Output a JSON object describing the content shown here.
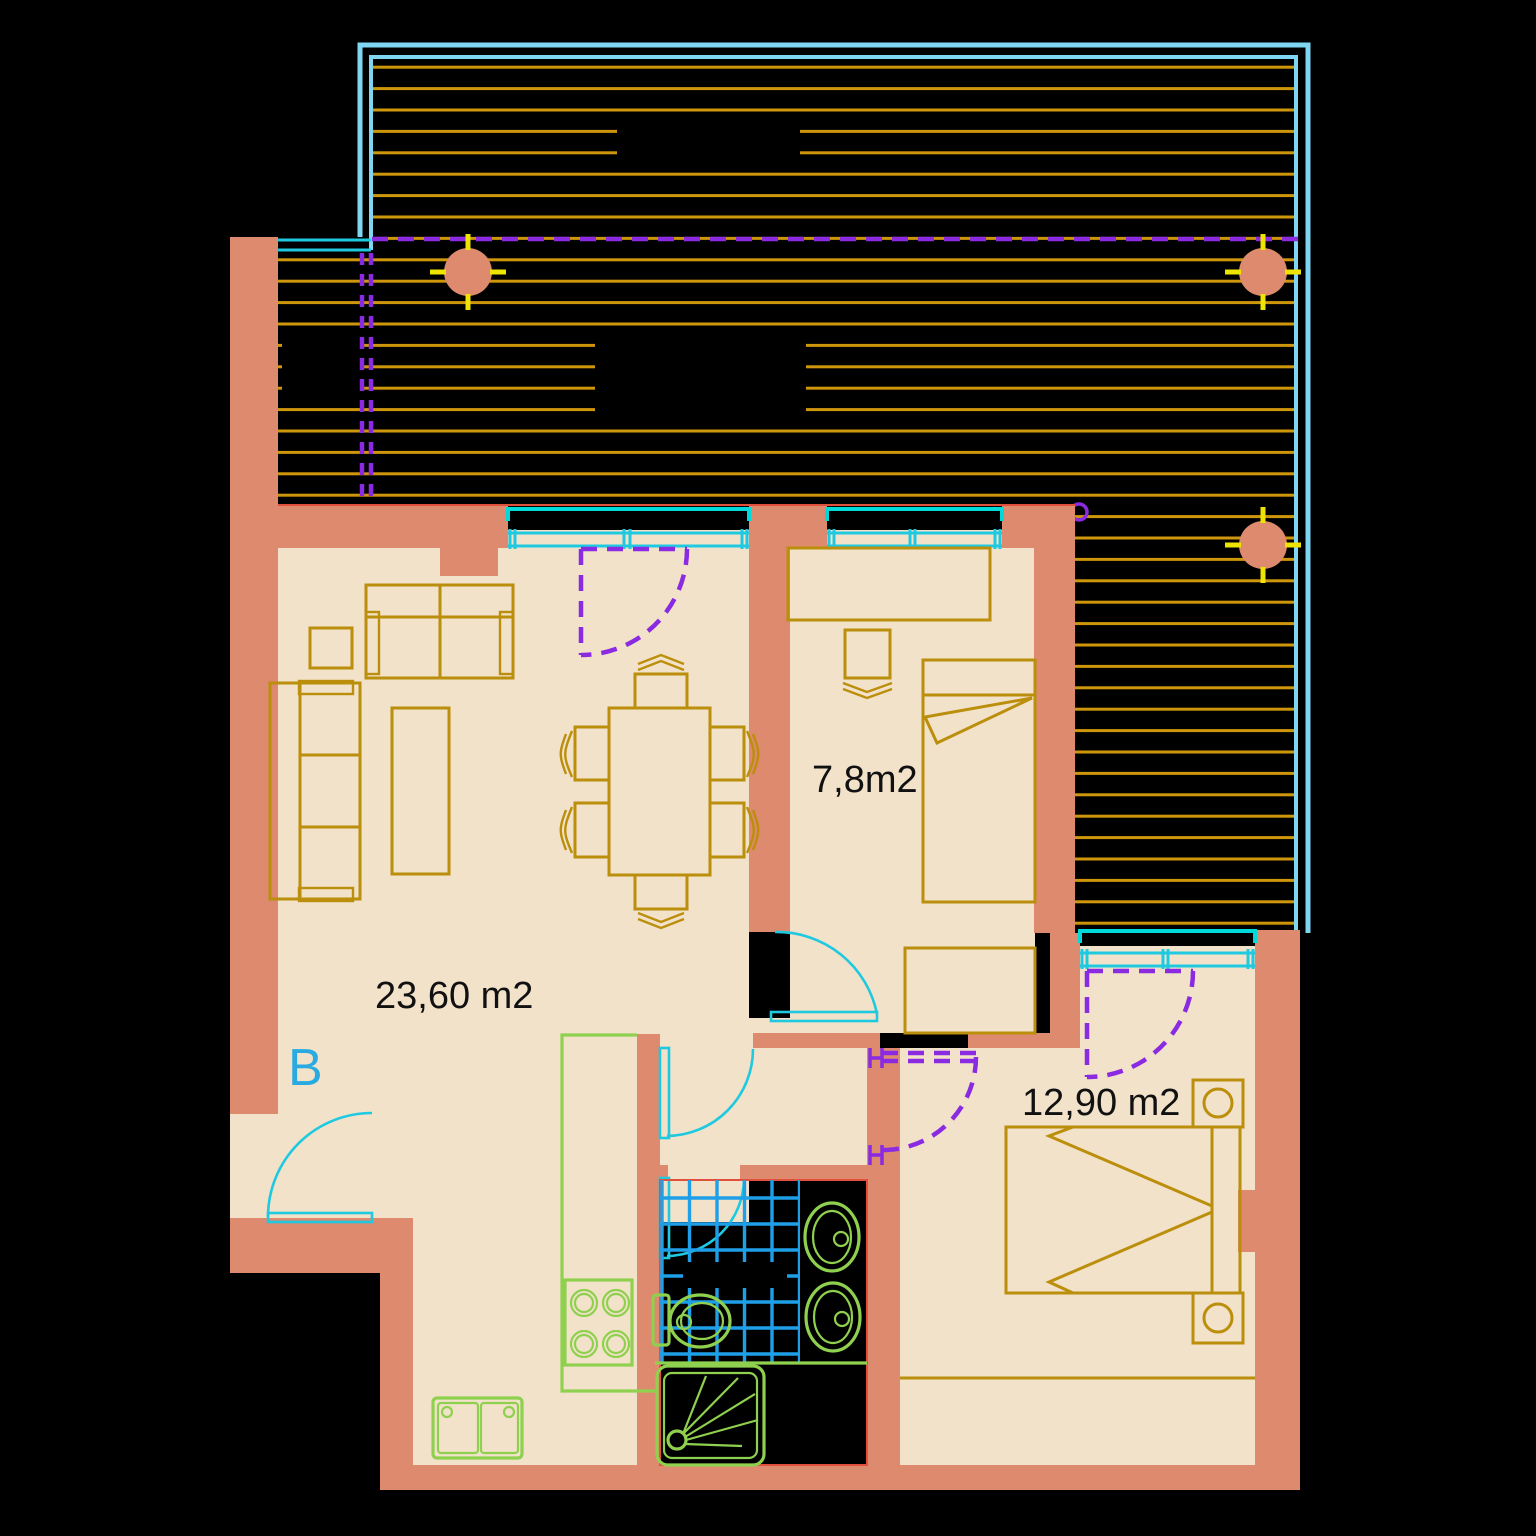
{
  "floor_plan": {
    "unit_label": "B",
    "rooms": [
      {
        "name": "living-dining",
        "area_label": "23,60 m2"
      },
      {
        "name": "small-bedroom",
        "area_label": "7,8m2"
      },
      {
        "name": "main-bedroom",
        "area_label": "12,90 m2"
      }
    ],
    "colors": {
      "background": "#000000",
      "walls": "#DD8A6E",
      "floor": "#F2E2CA",
      "furniture": "#BB8E0C",
      "terrace_hatch": "#CE960A",
      "terrace_border": "#7FD6F2",
      "window_frame": "#00D9D9",
      "windows": "#1FC9E0",
      "doors_swing": "#8A2BE2",
      "fixtures": "#8FD14F",
      "tiles": "#1E9FE8",
      "column_ticks": "#EFE400",
      "red_edge": "#E0503C",
      "unit_letter": "#29ABE2",
      "text": "#111111"
    }
  }
}
